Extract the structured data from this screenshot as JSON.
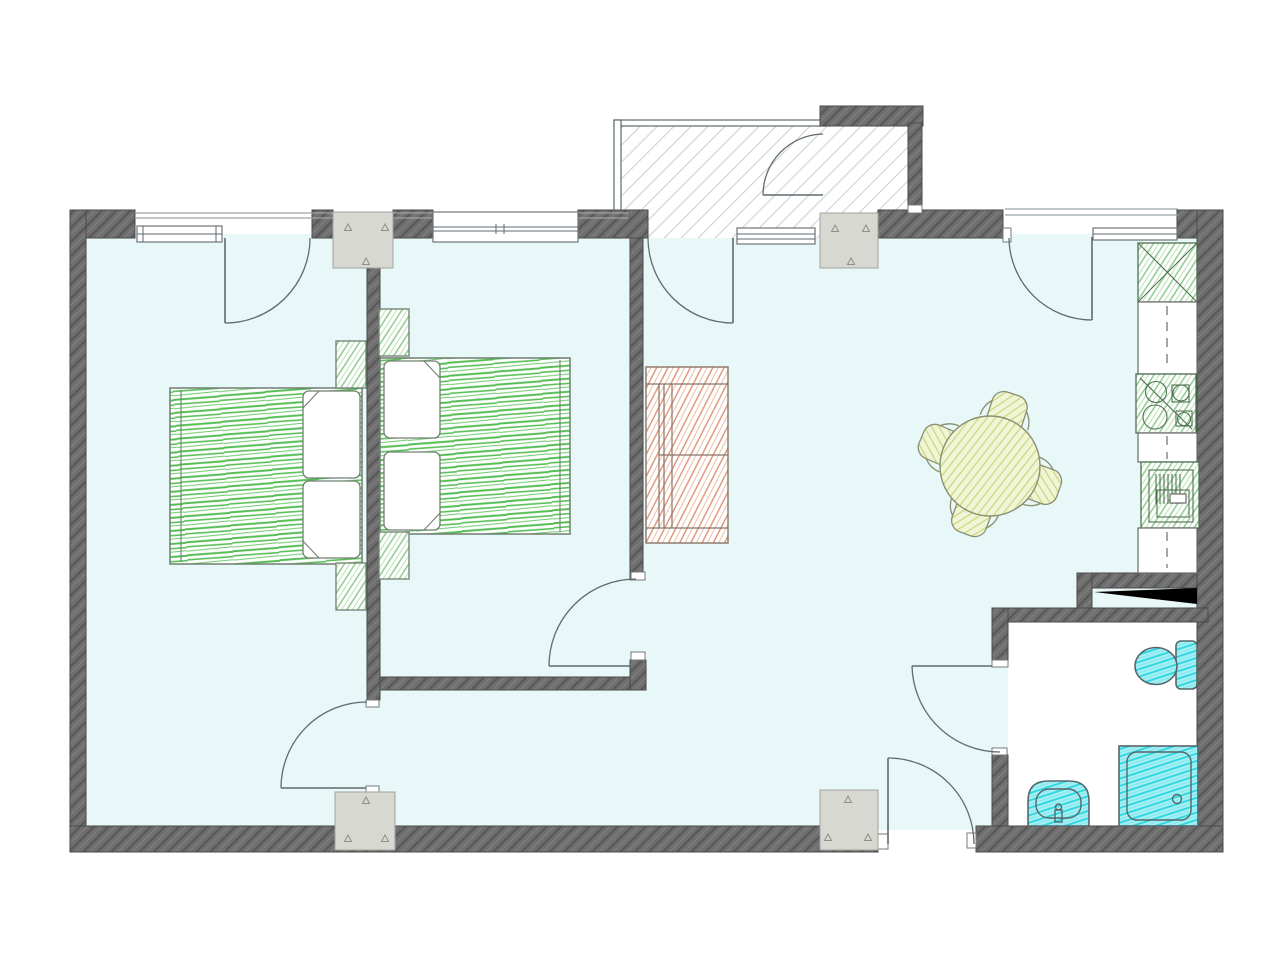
{
  "title": "apartment-floor-plan",
  "colors": {
    "floor": "#e8f7f7",
    "wallFill": "#6f6f6f",
    "wallLineDark": "#595959",
    "wallLineLight": "#818181",
    "wallStroke": "#4a4a4a",
    "outline": "#5f6b6e",
    "porchLine": "#ccd1d4",
    "columnFill": "#d8d8d3",
    "columnStroke": "#a2a29b",
    "triStroke": "#8f8f88",
    "furnGreen": "#5ac05a",
    "furnGreenStroke": "#6f7f70",
    "kitchenGreen": "#86c786",
    "kitchenStroke": "#4f7050",
    "wardrobeSalmon": "#db8a67",
    "wardrobeStroke": "#8a7468",
    "tableYellow": "#c9d97e",
    "tableYellowBg": "#f1f5d8",
    "tableStroke": "#8a8f70",
    "bathCyan": "#29d5e1",
    "bathCyanBg": "#a5eff3",
    "bathStroke": "#57666a",
    "wedge": "#000000"
  },
  "plan": {
    "rooms": [
      {
        "name": "bedroom-left",
        "furniture": [
          "double-bed",
          "pillow",
          "pillow",
          "nightstand",
          "nightstand"
        ]
      },
      {
        "name": "bedroom-middle",
        "furniture": [
          "double-bed",
          "pillow",
          "pillow",
          "nightstand",
          "nightstand"
        ]
      },
      {
        "name": "living-room",
        "furniture": [
          "wardrobe",
          "round-table",
          "chair",
          "chair",
          "chair",
          "chair"
        ]
      },
      {
        "name": "kitchen-zone",
        "furniture": [
          "fridge-unit",
          "counter",
          "cooktop",
          "counter",
          "oven-unit",
          "counter"
        ]
      },
      {
        "name": "bathroom",
        "furniture": [
          "toilet",
          "washbasin",
          "shower-tray"
        ]
      },
      {
        "name": "entrance-porch",
        "furniture": []
      }
    ],
    "openings": {
      "windows": 4,
      "doors": 8,
      "wall_columns": 4
    }
  }
}
